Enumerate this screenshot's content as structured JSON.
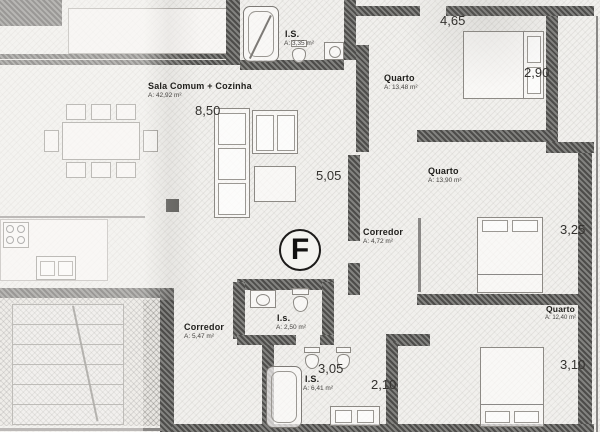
{
  "drawing": {
    "unit_marker": "F",
    "rooms": {
      "sala": {
        "name": "Sala Comum + Cozinha",
        "area": "A: 42,92 m²"
      },
      "is_top": {
        "name": "I.S.",
        "area": "A: 3,35 m²"
      },
      "quarto_1": {
        "name": "Quarto",
        "area": "A: 13,48 m²"
      },
      "quarto_2": {
        "name": "Quarto",
        "area": "A: 13,90 m²"
      },
      "quarto_3": {
        "name": "Quarto",
        "area": "A: 12,40 m²"
      },
      "corredor_right": {
        "name": "Corredor",
        "area": "A: 4,72 m²"
      },
      "corredor_bottom": {
        "name": "Corredor",
        "area": "A: 5,47 m²"
      },
      "is_small": {
        "name": "I.s.",
        "area": "A: 2,50 m²"
      },
      "is_main": {
        "name": "I.S.",
        "area": "A: 6,41 m²"
      }
    },
    "dimensions": {
      "sala_width": "8,50",
      "sala_depth": "5,05",
      "quarto1_width": "4,65",
      "quarto1_depth": "2,90",
      "quarto2_depth": "3,25",
      "quarto3_depth": "3,10",
      "is_main_width": "3,05",
      "is_main_depth": "2,10"
    },
    "colors": {
      "paper": "#f1f0ed",
      "wall": "#6e6d6a",
      "ink": "#21201d"
    }
  }
}
